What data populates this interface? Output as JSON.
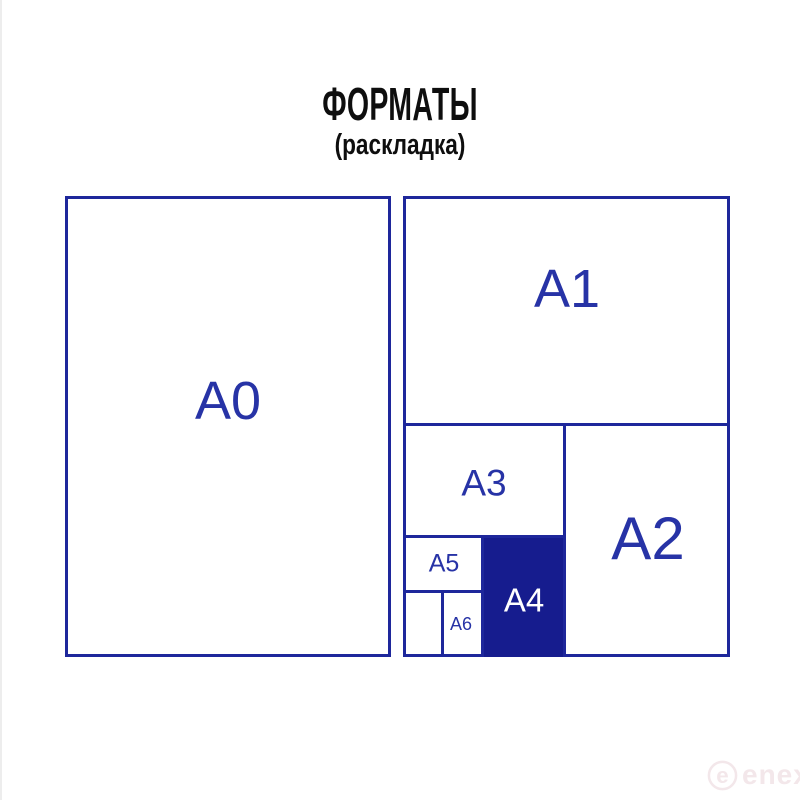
{
  "header": {
    "title": "ФОРМАТЫ",
    "subtitle": "(раскладка)"
  },
  "diagram": {
    "sheets": {
      "a0": {
        "label": "A0",
        "highlighted": false
      },
      "a1": {
        "label": "A1",
        "highlighted": false
      },
      "a2": {
        "label": "A2",
        "highlighted": false
      },
      "a3": {
        "label": "A3",
        "highlighted": false
      },
      "a4": {
        "label": "A4",
        "highlighted": true
      },
      "a5": {
        "label": "A5",
        "highlighted": false
      },
      "a6": {
        "label": "A6",
        "highlighted": false
      }
    }
  },
  "colors": {
    "outline_blue": "#1e279b",
    "label_blue": "#2733a6",
    "a4_fill_blue": "#161c8e",
    "a4_label_white": "#ffffff",
    "title_black": "#0e0e0e",
    "watermark_pink": "#f3e7ea"
  },
  "watermark": {
    "brand": "enex",
    "icon": "enex-circle-e-icon"
  }
}
